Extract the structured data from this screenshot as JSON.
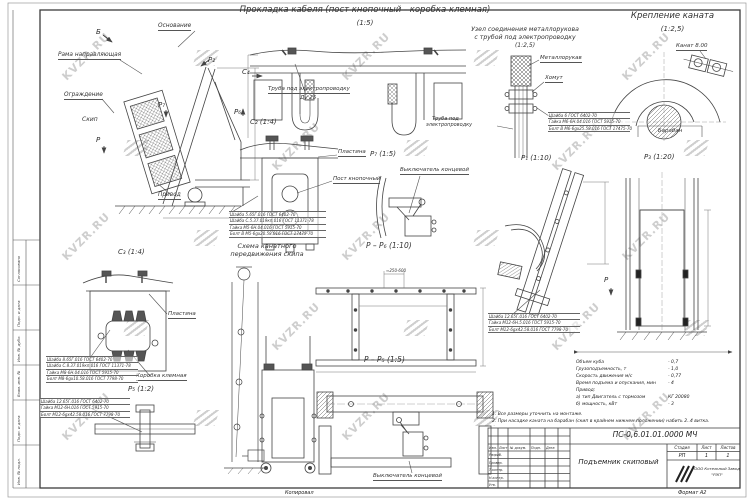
{
  "watermark": {
    "text": "KVZR.RU"
  },
  "sheet": {
    "kopiroval": "Копировал",
    "format": "Формат А2",
    "margin_labels": [
      "Согласовано",
      "Подп. и дата",
      "Инв. № дубл.",
      "Взам. инв. №",
      "Подп. и дата",
      "Инв. № подл."
    ]
  },
  "views": {
    "main": {
      "osnovanie": "Основание",
      "rama": "Рама направляющая",
      "ograzhdenie": "Ограждение",
      "skip": "Скип",
      "privod": "Привод",
      "marks": {
        "b": "Б",
        "p2": "P₂",
        "p7": "P₇",
        "p6": "P₆",
        "p": "P",
        "c4": "C₄"
      }
    },
    "cable": {
      "title": "Прокладка кабеля (пост кнопочный - коробка клемная)",
      "scale": "(1:5)",
      "tube": "Труба под электропроводку",
      "du": "Ду 25"
    },
    "uzel": {
      "title1": "Узел соединения металлорукова",
      "title2": "с трубой под электропроводку",
      "scale": "(1:2,5)",
      "metallorukav": "Металлорукав",
      "khomut": "Хомут",
      "truba1": "Труба под",
      "truba2": "электропроводку",
      "parts": [
        "Шайба 6 ГОСТ 6402-70",
        "Гайка М6-6Н.04.016 ГОСТ 5915-70",
        "Болт В М6-6gх25.58.016 ГОСТ 17475-70"
      ]
    },
    "kreplenie": {
      "title": "Крепление каната",
      "scale": "(1:2,5)",
      "kanat": "Канат 8.00",
      "baraban": "Барабан"
    },
    "c2": {
      "label": "C₂ (1:4)",
      "plastina": "Пластина",
      "post": "Пост кнопочный",
      "parts": [
        "Шайба 5.65Г.016 ГОСТ 6402-70",
        "Шайба С.5.37.019кп.016 ГОСТ 11371-78",
        "Гайка М5-6Н.04.016 ГОСТ 5915-70",
        "Болт В М5-6gх20.58.016 ГОСТ 17475-70"
      ]
    },
    "c3": {
      "label": "C₃ (1:4)",
      "plastina": "Пластина",
      "korobka": "Коробка клемная",
      "parts": [
        "Шайба 8.65Г.016 ГОСТ 6402-70",
        "Шайба С.8.37.019кп.016 ГОСТ 11371-78",
        "Гайка М8-6Н.04.016 ГОСТ 5915-70",
        "Болт М8-6gх10.58.016 ГОСТ 7798-70"
      ]
    },
    "p5": {
      "label": "P₅ (1:2)",
      "parts": [
        "Шайба 12.65Г.016 ГОСТ 6402-70",
        "Гайка М12-6Н.016 ГОСТ 5915-70",
        "Болт М12-6gх42.58.016 ГОСТ 7798-70"
      ]
    },
    "p7": {
      "label": "P₇ (1:5)",
      "vykl": "Выключатель концевой"
    },
    "p1": {
      "label": "P₁ (1:10)",
      "mark": "P",
      "parts": [
        "Шайба 12.65Г.016 ГОСТ 6402-70",
        "Гайка М12-6Н.5.016 ГОСТ 5915-70",
        "Болт М12-6gх42.58.016 ГОСТ 7798-70"
      ]
    },
    "p3": {
      "label": "P₃ (1:20)"
    },
    "shema": {
      "title1": "Схема канатного",
      "title2": "передвижения скипа"
    },
    "pp6": {
      "label": "P – P₆ (1:10)",
      "dim": "≈250-600"
    },
    "pp5": {
      "label": "P – P₅ (1:5)",
      "vykl": "Выключатель концевой"
    }
  },
  "tech": {
    "rows": [
      {
        "label": "Объем куба",
        "value": "- 0,7"
      },
      {
        "label": "Грузоподъемность, т",
        "value": "- 1,0"
      },
      {
        "label": "Скорость движения м/с",
        "value": "- 0,77"
      },
      {
        "label": "Время подъема и опускания, мин",
        "value": "- 4"
      },
      {
        "label": "Привод:",
        "value": ""
      },
      {
        "label": "а) тип Двигатель с тормозом",
        "value": "КГ 20080"
      },
      {
        "label": "б) мощность, кВт",
        "value": "- 3"
      }
    ]
  },
  "notes": [
    "1. Все размеры уточнить на монтаже.",
    "2. При насадке каната на барабан (скип в крайнем нижнем положении) набить 2..4 витка."
  ],
  "titleblock": {
    "doc": "ПС-0,6.01.01.0000 МЧ",
    "name": "Подъемник скиповый",
    "stage_h": "Стадия",
    "sheet_h": "Лист",
    "sheets_h": "Листов",
    "stage": "РП",
    "sheet": "1",
    "sheets": "1",
    "company1": "ООО Котельный Завод",
    "company2": "\"РЭП\"",
    "hdr": [
      "Изм.",
      "Лист",
      "№ докум.",
      "Подп.",
      "Дата"
    ],
    "sig": [
      "Разраб.",
      "Провер.",
      "Т.контр.",
      "Н.контр.",
      "Утв."
    ]
  }
}
